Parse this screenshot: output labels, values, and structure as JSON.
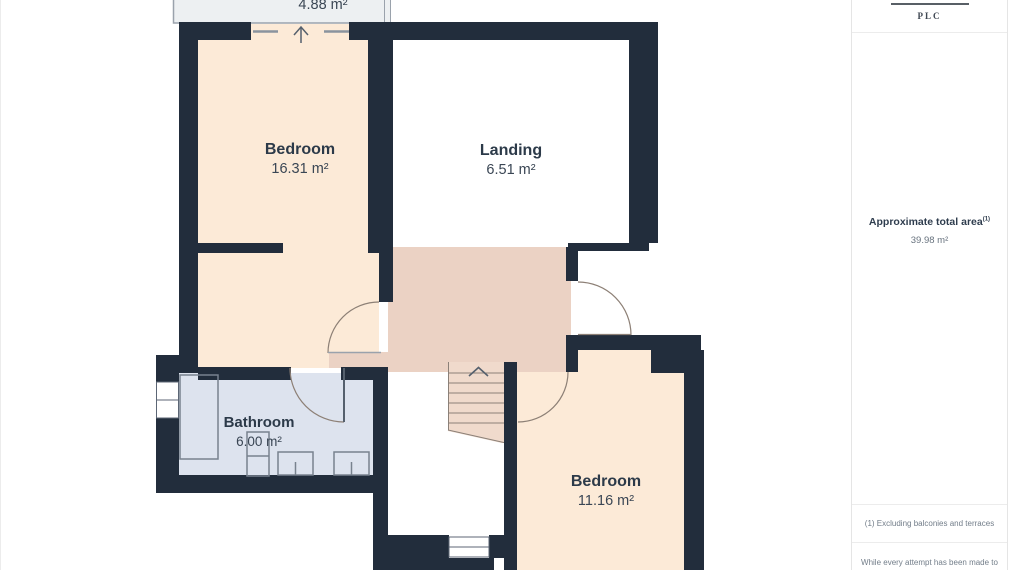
{
  "plan": {
    "balcony": {
      "area": "4.88 m²"
    },
    "bedroom_top": {
      "name": "Bedroom",
      "area": "16.31 m²"
    },
    "landing": {
      "name": "Landing",
      "area": "6.51 m²"
    },
    "bathroom": {
      "name": "Bathroom",
      "area": "6.00 m²"
    },
    "bedroom_bottom": {
      "name": "Bedroom",
      "area": "11.16 m²"
    }
  },
  "sidebar": {
    "logo": "PLC",
    "total_area": {
      "label": "Approximate total area",
      "superscript": "(1)",
      "value": "39.98 m²"
    },
    "footnotes": [
      "(1) Excluding balconies and terraces",
      "While every attempt has been made to"
    ]
  },
  "colors": {
    "wall": "#222d3c",
    "room_peach": "#fcead7",
    "hall_tan": "#ebd2c4",
    "stairs_tan": "#f0dacc",
    "bathroom_blue": "#dde3ee",
    "balcony_grey": "#edf0f2",
    "door_arc": "#8d8076",
    "fixture_stroke": "#78828e"
  }
}
